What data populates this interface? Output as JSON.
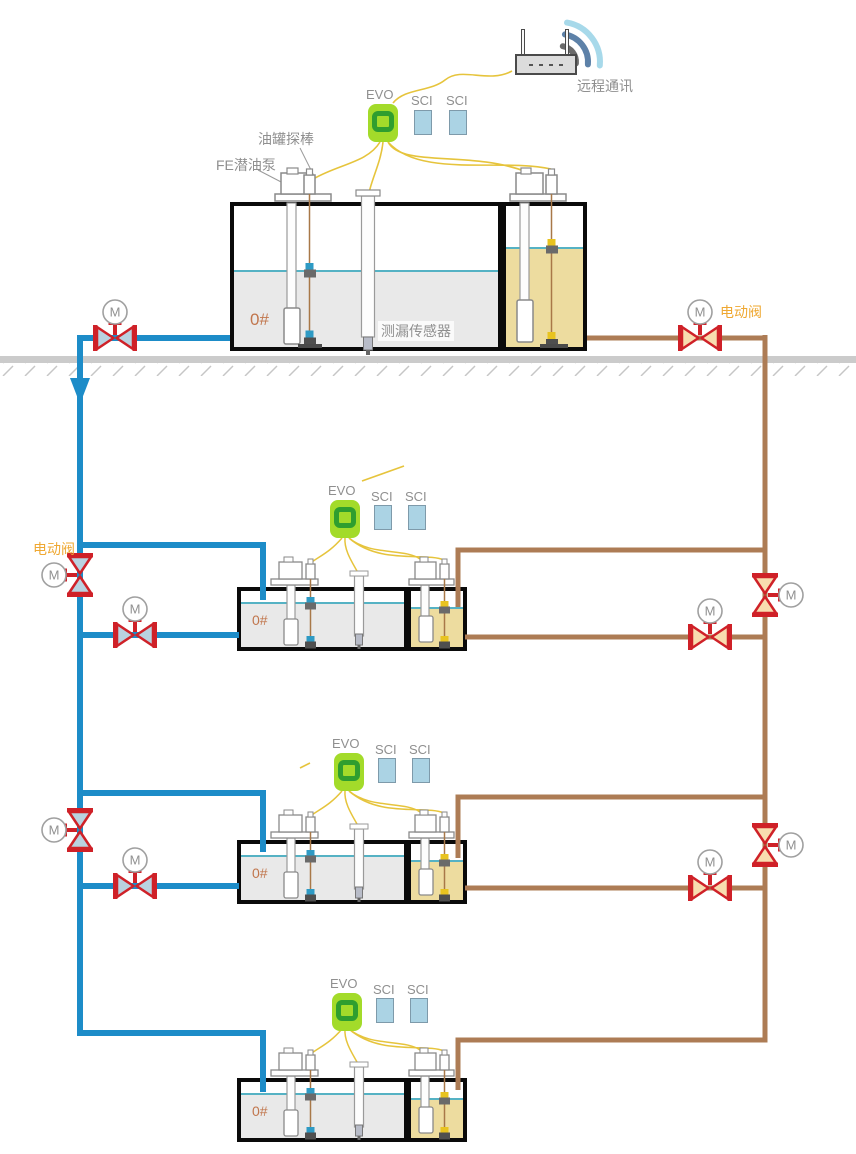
{
  "labels": {
    "remote_comm": "远程通讯",
    "evo": "EVO",
    "sci": "SCI",
    "tank_probe": "油罐探棒",
    "submersible_pump": "FE潜油泵",
    "leak_sensor": "测漏传感器",
    "electric_valve": "电动阀",
    "motor": "M"
  },
  "system": {
    "controller_count": 4,
    "sci_module_count": 8,
    "motor_valve_count": 10,
    "tanks": [
      {
        "id": 1,
        "product": "0#",
        "compartments": 2
      },
      {
        "id": 2,
        "product": "0#",
        "compartments": 2
      },
      {
        "id": 3,
        "product": "0#",
        "compartments": 2
      },
      {
        "id": 4,
        "product": "0#",
        "compartments": 2
      }
    ]
  },
  "colors": {
    "supply_pipe_blue": "#1d8cc8",
    "return_pipe_brown": "#ad7c55",
    "valve_red": "#cf2128",
    "valve_fill_blue": "#b9d2e0",
    "valve_fill_tan": "#f8ddb0",
    "wire_yellow": "#e6c43c",
    "evo_green": "#a3db2a",
    "evo_ring_green": "#2f9e2f",
    "sci_blue": "#abd3e4",
    "liquid_gray": "#e9e9e9",
    "liquid_tan": "#eddc9f",
    "liquid_line_cyan": "#55b2c4",
    "label_gray": "#8f8f8f",
    "label_orange": "#efa832",
    "product_orange": "#c1764d"
  }
}
